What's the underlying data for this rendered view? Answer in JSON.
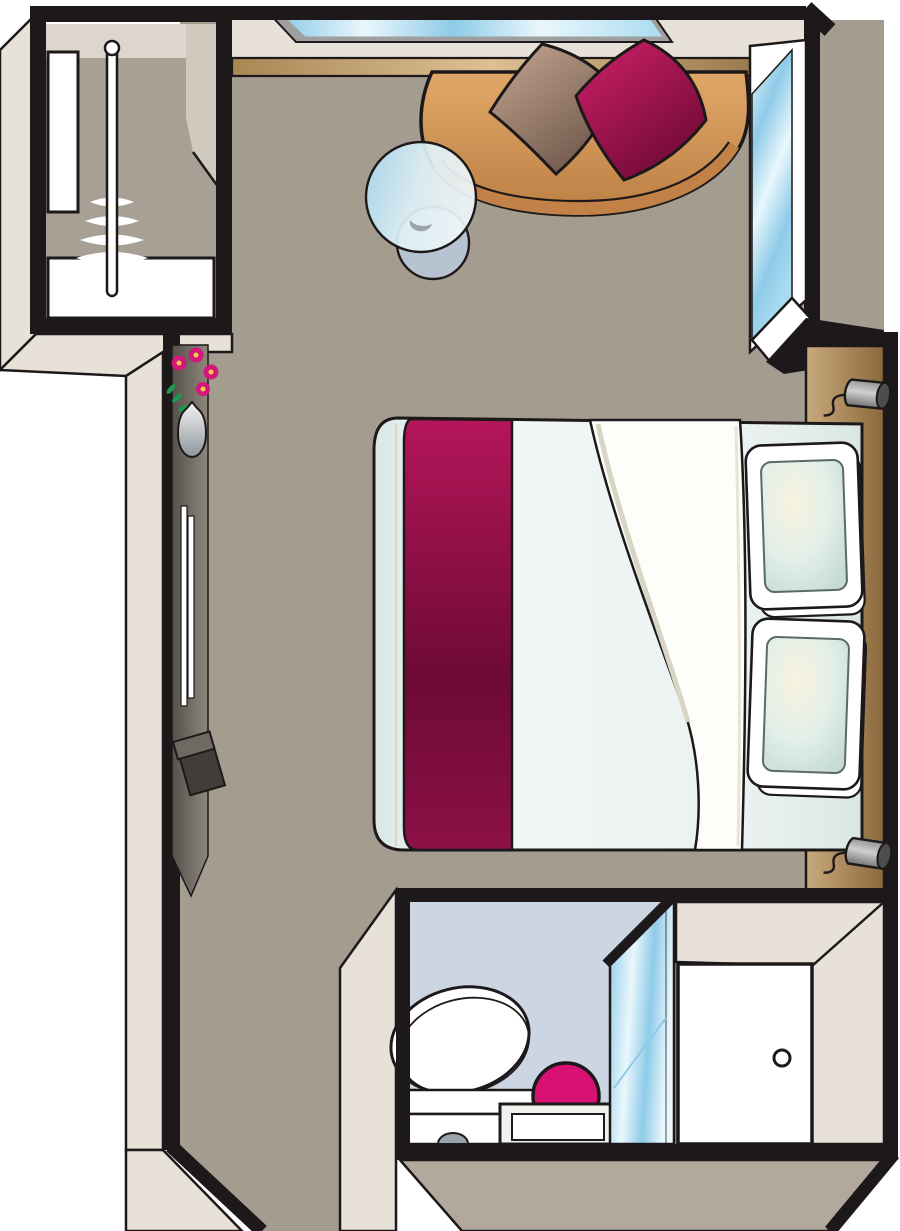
{
  "image": {
    "type": "floor-plan-illustration",
    "subject": "top-down axonometric hotel/cruise cabin stateroom floor plan",
    "width_px": 900,
    "height_px": 1231,
    "visible_text": ""
  },
  "colors": {
    "outline": "#1d191a",
    "white": "#ffffff",
    "floor": "#a59c90",
    "wall_face": "#e7e1d8",
    "band": "#b2a89b",
    "closet_interior": "#a8a094",
    "closet_top_face": "#dcd6cc",
    "closet_side_face": "#cfc9be",
    "window_frame": "#9f9f9f",
    "glass_mid": "#8ecbe8",
    "glass_hi": "#e9f7fc",
    "glass_deep": "#a9dcf0",
    "ledge_a": "#a98753",
    "ledge_hi": "#dcc094",
    "ledge_b": "#8d6c3e",
    "sofa_a": "#e0a868",
    "sofa_b": "#bd7f44",
    "sofa_edge": "#c28146",
    "cushion_taupe_a": "#c6a893",
    "cushion_taupe_b": "#6f574a",
    "cushion_magenta_a": "#d1206a",
    "cushion_magenta_b": "#6f0a36",
    "bed_edge": "#d9e6e4",
    "bed_hi": "#f3f8f7",
    "bed_mid": "#e9f1f0",
    "runner_a": "#b5165a",
    "runner_b": "#8c1047",
    "runner_c": "#6d0a35",
    "blanket_white": "#fdfdfa",
    "blanket_shadow": "#d9d5c4",
    "pillow_hi": "#f8f2de",
    "pillow_mid": "#e3efe9",
    "pillow_edge": "#c6dbd6",
    "pillow_trim": "#5a6a6a",
    "headboard_a": "#c9aa7d",
    "headboard_b": "#8a683c",
    "lamp_a": "#8f8f8f",
    "lamp_hi": "#cfcfcf",
    "lamp_b": "#6f6f6f",
    "lamp_cap": "#4d4d4d",
    "table_a": "#a5d8ee",
    "table_hi": "#dff0f7",
    "table_pale": "#eef6f8",
    "table_base": "#b9c8d8",
    "counter_a": "#54514b",
    "counter_b": "#8e877c",
    "cabinet_dark": "#413e3a",
    "cabinet_top": "#6e6961",
    "vase_a": "#f4f4f4",
    "vase_b": "#8f979c",
    "flower": "#d4177c",
    "flower_center": "#f7c948",
    "stem": "#1e9a4e",
    "bath_floor": "#ccd6e2",
    "stool": "#d81272",
    "vanity_white": "#f2f1ee",
    "toilet_trim": "#9aa4ac"
  },
  "objects": [
    {
      "name": "wardrobe",
      "detail": "closet with hanging rod and 6 hangers plus white shelves"
    },
    {
      "name": "top-window",
      "detail": "long slanted window in top wall"
    },
    {
      "name": "right-window",
      "detail": "tall window in upper right wall"
    },
    {
      "name": "ledge-shelf",
      "detail": "wood-tone ledge along top wall"
    },
    {
      "name": "sofa",
      "detail": "curved tan sofa in top corner"
    },
    {
      "name": "cushion-taupe",
      "detail": "taupe throw cushion"
    },
    {
      "name": "cushion-magenta",
      "detail": "magenta throw cushion"
    },
    {
      "name": "cocktail-table",
      "detail": "round glass table"
    },
    {
      "name": "vanity-counter",
      "detail": "dark desk counter along left wall"
    },
    {
      "name": "flower-vase",
      "detail": "vase with pink flowers"
    },
    {
      "name": "wall-mirror",
      "detail": "long mirror strip on counter"
    },
    {
      "name": "cabinet",
      "detail": "dark box / stool under counter"
    },
    {
      "name": "double-bed",
      "detail": "bed with pale duvet"
    },
    {
      "name": "bed-runner",
      "detail": "magenta runner across foot of bed"
    },
    {
      "name": "duvet-fold",
      "detail": "white folded blanket"
    },
    {
      "name": "pillows",
      "detail": "two layered pillows at headboard"
    },
    {
      "name": "headboard",
      "detail": "wood headboard panel along right wall"
    },
    {
      "name": "reading-lamps",
      "detail": "two wall-mounted reading lamps with cords"
    },
    {
      "name": "bathroom",
      "detail": "en-suite with pale blue floor"
    },
    {
      "name": "toilet",
      "detail": "toilet seen from above"
    },
    {
      "name": "washbasin-stool",
      "detail": "round magenta basin/stool"
    },
    {
      "name": "vanity-unit",
      "detail": "white bathroom vanity"
    },
    {
      "name": "shower-screen",
      "detail": "glass shower partition"
    },
    {
      "name": "entry-door",
      "detail": "white entry door with round knob"
    }
  ]
}
